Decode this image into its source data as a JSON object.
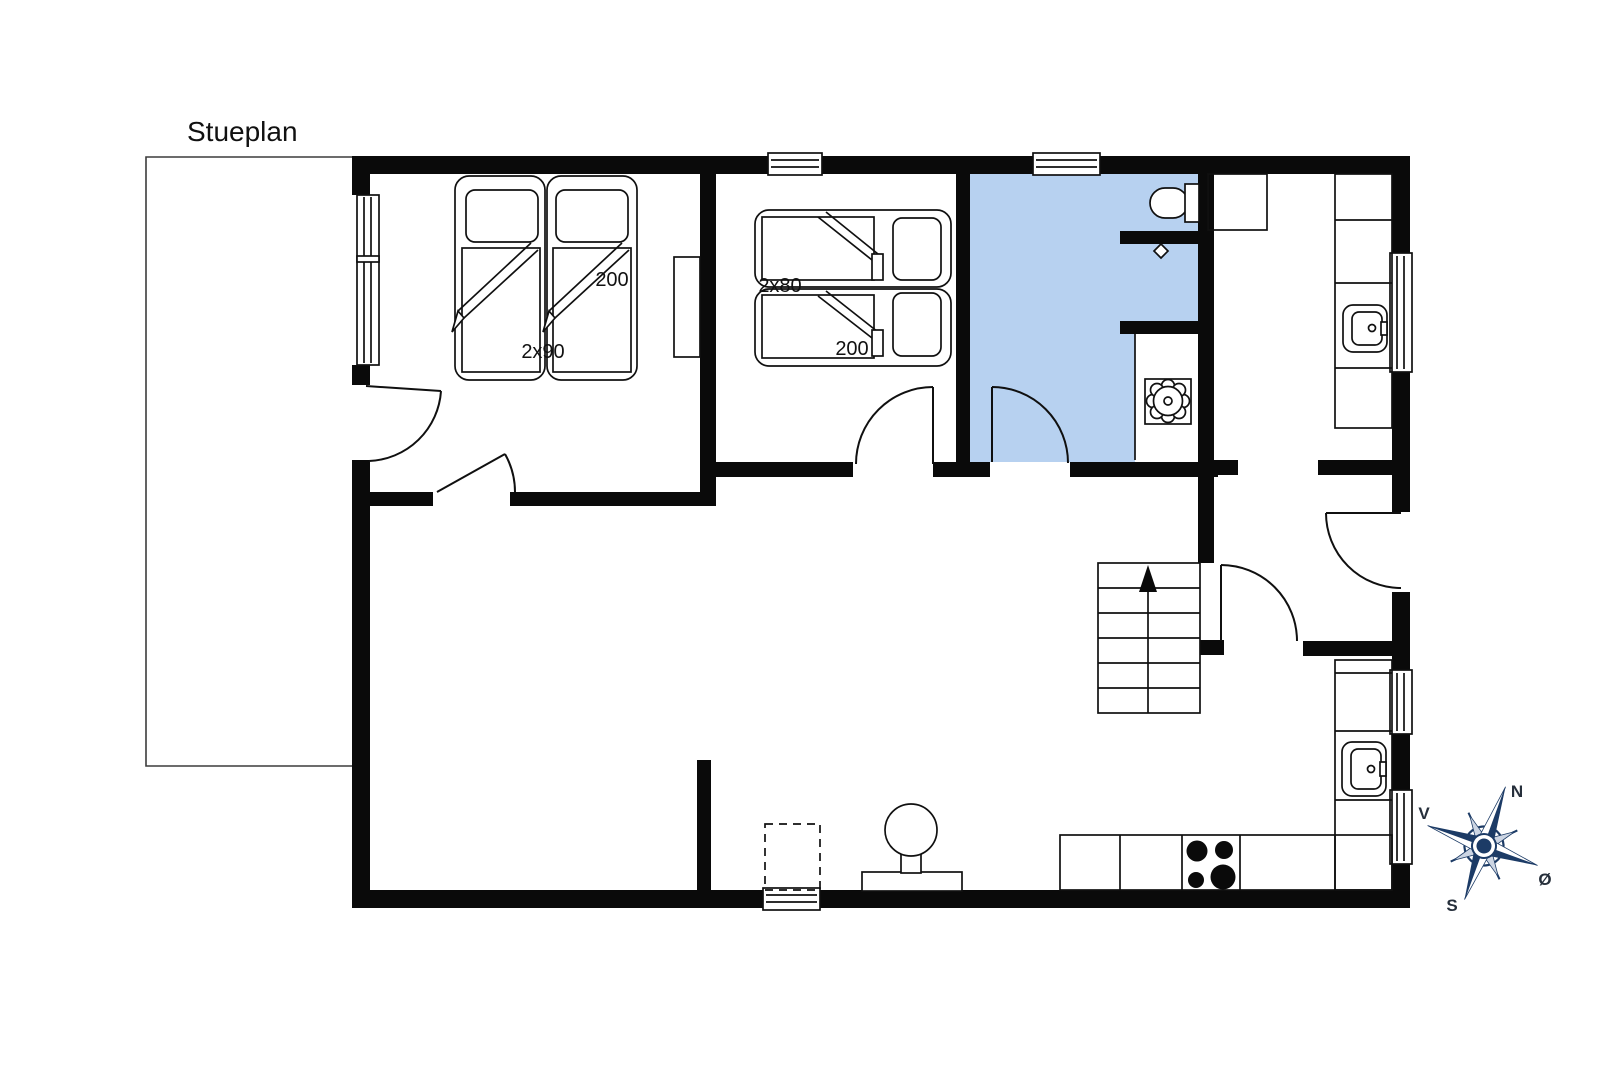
{
  "title": "Stueplan",
  "labels": {
    "bedroom1_width": "2x90",
    "bedroom1_length": "200",
    "bedroom2_width": "2x80",
    "bedroom2_length": "200"
  },
  "compass": {
    "north": "N",
    "east": "Ø",
    "south": "S",
    "west": "V"
  },
  "colors": {
    "wall": "#0a0a0a",
    "room_highlight": "#b7d1f0",
    "compass_dark": "#1c3b66",
    "compass_light": "#ccd5e3",
    "line": "#101010",
    "text": "#111111"
  },
  "fixtures": [
    "twin-bed-2x90",
    "twin-bed-2x80",
    "wardrobe",
    "toilet",
    "shower-drain",
    "washing-machine",
    "utility-sink",
    "kitchen-sink",
    "hob-4-burners",
    "wood-stove",
    "stairs-up-arrow",
    "terrace-outline",
    "compass-rose"
  ]
}
